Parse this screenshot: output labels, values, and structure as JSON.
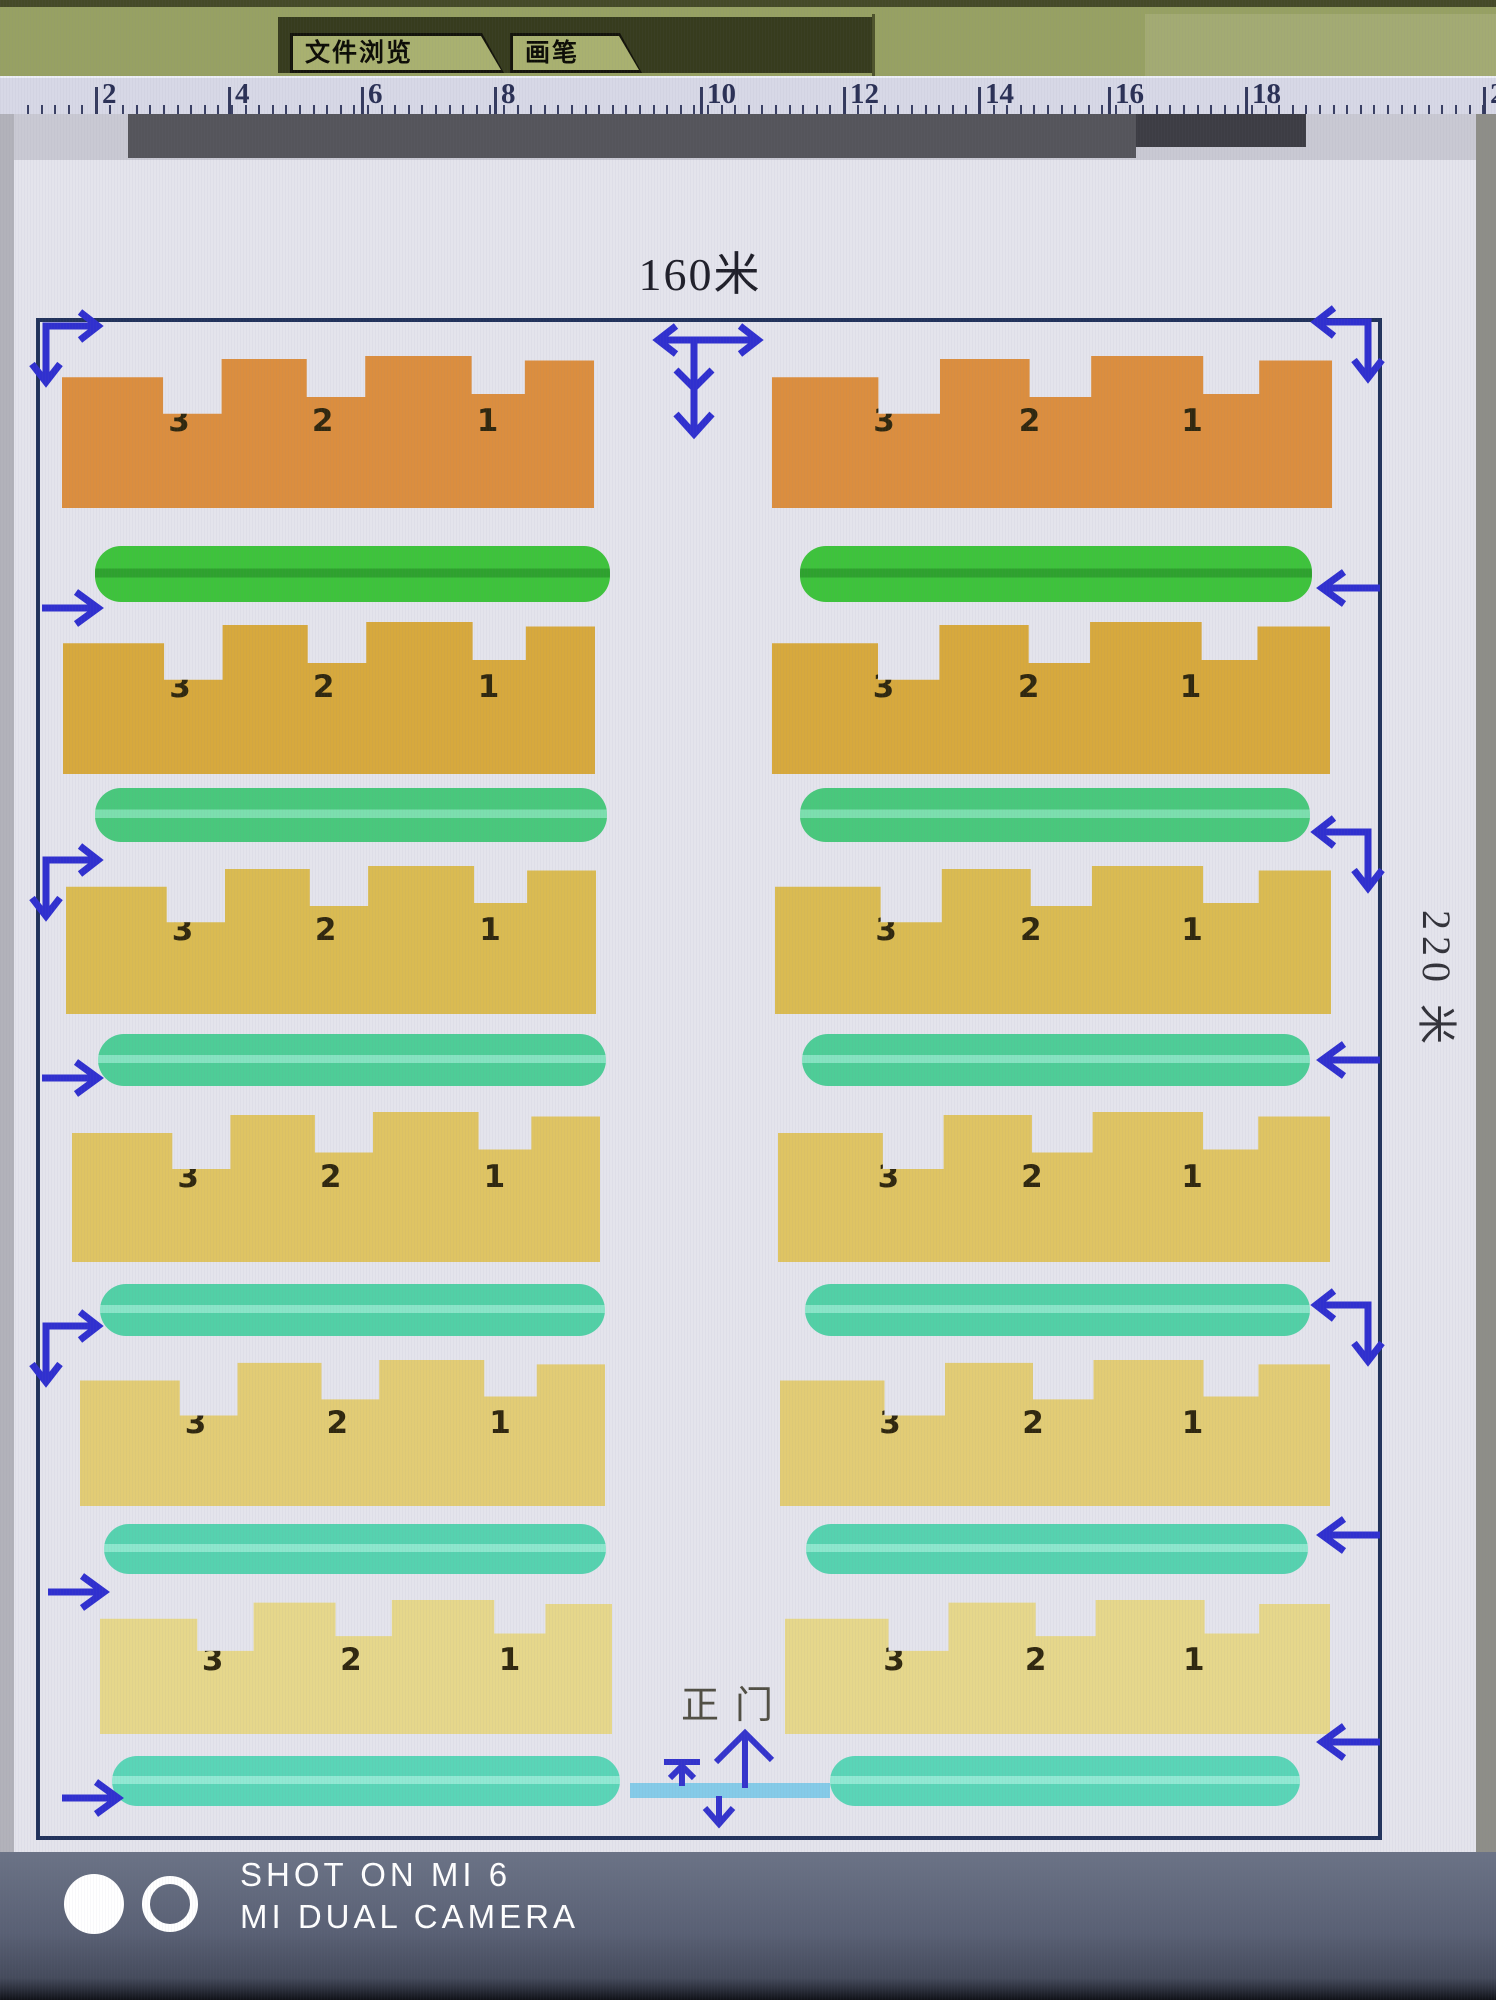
{
  "window": {
    "tabs": [
      {
        "label": "文件浏览"
      },
      {
        "label": "画笔"
      }
    ]
  },
  "ruler": {
    "unit_labels": [
      "2",
      "4",
      "6",
      "8",
      "10",
      "12",
      "14",
      "16",
      "18",
      "2"
    ]
  },
  "plan": {
    "top_dimension": "160米",
    "side_dimension": "220 米",
    "gate_label": "正门",
    "rows": [
      {
        "label": "row-1",
        "units": [
          "3",
          "2",
          "1"
        ],
        "building_color": "#db8e3f",
        "belt_color": "#3ec33c",
        "belt_stripe": "#2ea22e"
      },
      {
        "label": "row-2",
        "units": [
          "3",
          "2",
          "1"
        ],
        "building_color": "#d7a93d",
        "belt_color": "#49c87c",
        "belt_stripe": "#7cdfae"
      },
      {
        "label": "row-3",
        "units": [
          "3",
          "2",
          "1"
        ],
        "building_color": "#dabb52",
        "belt_color": "#4ecd97",
        "belt_stripe": "#86e3c1"
      },
      {
        "label": "row-4",
        "units": [
          "3",
          "2",
          "1"
        ],
        "building_color": "#dfc463",
        "belt_color": "#52d0a6",
        "belt_stripe": "#8ae5c8"
      },
      {
        "label": "row-5",
        "units": [
          "3",
          "2",
          "1"
        ],
        "building_color": "#e2cc75",
        "belt_color": "#56d2af",
        "belt_stripe": "#8de7cd"
      },
      {
        "label": "row-6",
        "units": [
          "3",
          "2",
          "1"
        ],
        "building_color": "#e6d78b",
        "belt_color": "#5ad5b7",
        "belt_stripe": "#91e9d3"
      }
    ]
  },
  "icons": {
    "corner_flow_arrow": "elbow-double-headed-arrow",
    "lane_flow_arrow": "straight-arrow",
    "entrance_arrows": "up-and-down-arrows",
    "top_circulation_symbol": "horizontal-double-arrow-with-down-arrows"
  },
  "colors": {
    "arrow": "#3030cf",
    "plan_border": "#22335c",
    "page": "#e4e4ec",
    "gate_bar": "#85cbe8",
    "toolbar": "#97a163",
    "ruler_ink": "#2b3156"
  },
  "watermark": {
    "line1": "SHOT ON MI 6",
    "line2": "MI DUAL CAMERA"
  }
}
